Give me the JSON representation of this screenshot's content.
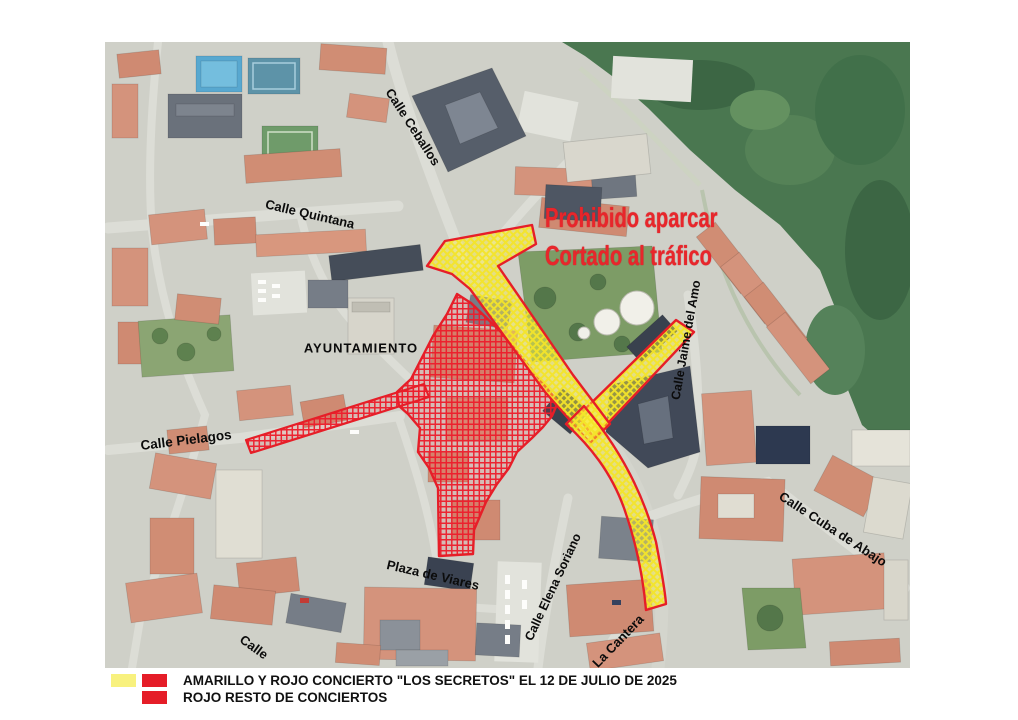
{
  "annotation": {
    "line1": "Prohibido aparcar",
    "line2": "Cortado al tráfico",
    "color": "#e8262b"
  },
  "map": {
    "street_labels": [
      {
        "text": "Calle Ceballos",
        "x": 413,
        "y": 127,
        "rot": 57,
        "size": 13
      },
      {
        "text": "Calle  Quintana",
        "x": 310,
        "y": 214,
        "rot": 13,
        "size": 13
      },
      {
        "text": "AYUNTAMIENTO",
        "x": 361,
        "y": 348,
        "rot": 0,
        "size": 13,
        "spacing": 1
      },
      {
        "text": "Calle  Pielagos",
        "x": 186,
        "y": 440,
        "rot": -7,
        "size": 13.5
      },
      {
        "text": "Calle  Jaime del Amo",
        "x": 686,
        "y": 340,
        "rot": -80,
        "size": 12.5
      },
      {
        "text": "Calle  Cuba  de  Abajo",
        "x": 833,
        "y": 529,
        "rot": 33,
        "size": 13
      },
      {
        "text": "Plaza de Viares",
        "x": 433,
        "y": 575,
        "rot": 13,
        "size": 13
      },
      {
        "text": "Calle  Elena Soriano",
        "x": 553,
        "y": 587,
        "rot": -65,
        "size": 12.5
      },
      {
        "text": "La Cantera",
        "x": 618,
        "y": 641,
        "rot": -46,
        "size": 13
      },
      {
        "text": "Calle",
        "x": 254,
        "y": 647,
        "rot": 36,
        "size": 13
      }
    ]
  },
  "legend": {
    "colors": {
      "yellow": "#f8f17e",
      "red": "#e51d28"
    },
    "rows": [
      {
        "swatches": [
          "yellow",
          "red"
        ],
        "text": "AMARILLO Y ROJO CONCIERTO \"LOS SECRETOS\" EL 12 DE JULIO DE 2025"
      },
      {
        "swatches": [
          null,
          "red"
        ],
        "text": "ROJO RESTO DE CONCIERTOS"
      }
    ]
  },
  "overlay_colors": {
    "outline": "#e61e28",
    "red_hatch": "#ed1c2b",
    "yellow_hatch": "#f4e42a"
  }
}
